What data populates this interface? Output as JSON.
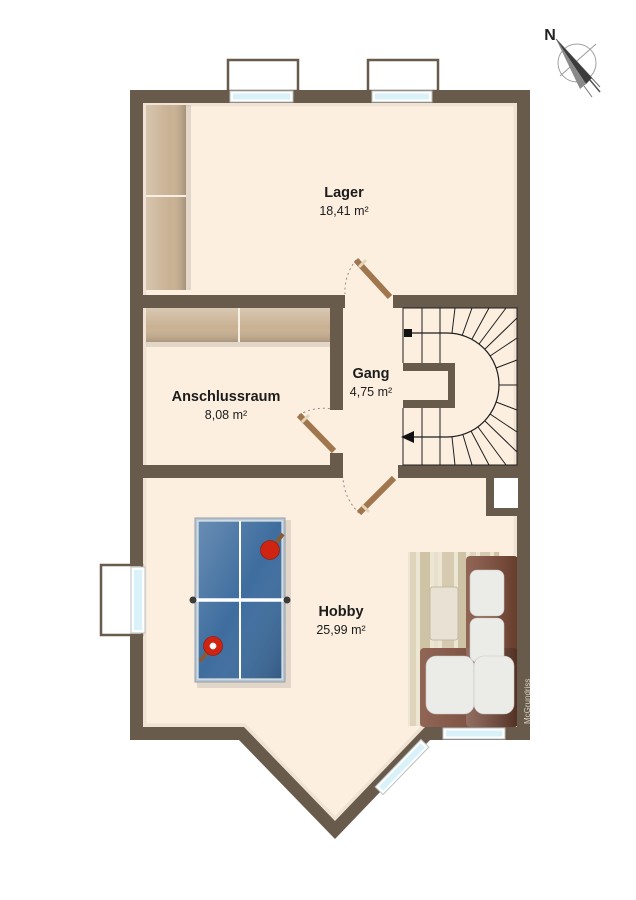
{
  "plan": {
    "compass_label": "N",
    "watermark": "McGrundriss",
    "rooms": [
      {
        "name": "Lager",
        "area": "18,41 m²"
      },
      {
        "name": "Anschlussraum",
        "area": "8,08 m²"
      },
      {
        "name": "Gang",
        "area": "4,75 m²"
      },
      {
        "name": "Hobby",
        "area": "25,99 m²"
      }
    ]
  },
  "colors": {
    "wall": "#685b4c",
    "floor": "#fcefdf",
    "wood": "#c9b193",
    "window_glass": "#d9f1f8",
    "table_blue": "#3e6d9e",
    "paddle_red": "#cf2412",
    "sofa_brown": "#7e4a37",
    "cushion": "#ebebe8",
    "rug_base": "#ede6d3"
  }
}
